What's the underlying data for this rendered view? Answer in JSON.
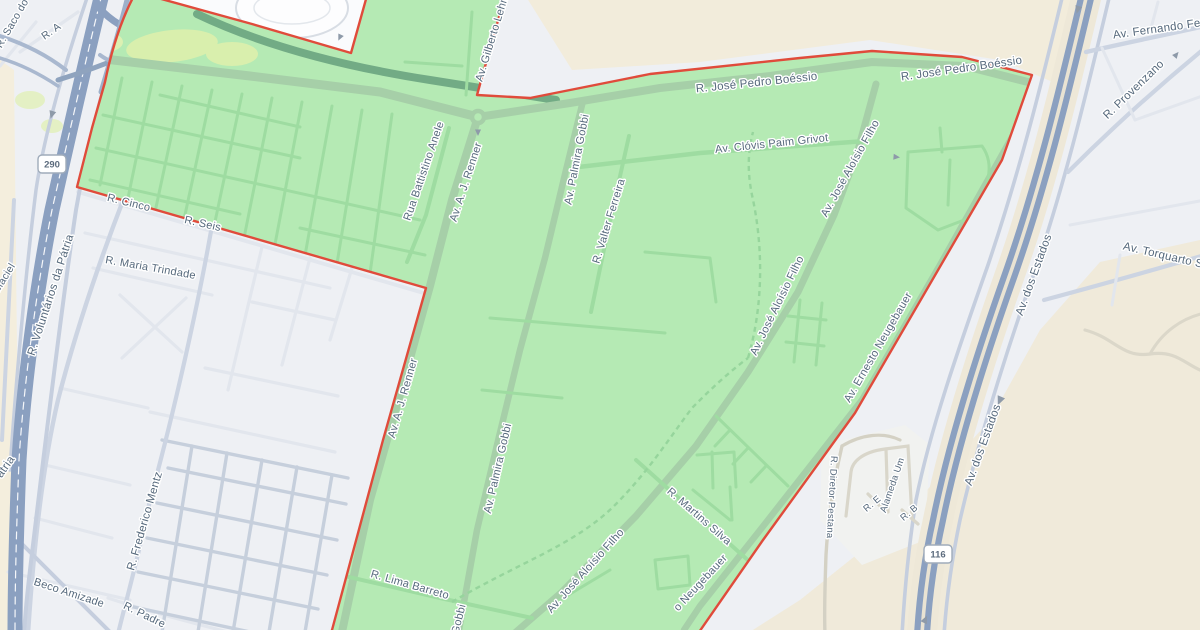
{
  "map": {
    "description": "street map with highlighted district polygon",
    "highlighted_region": {
      "name": "highlighted-district",
      "fill_color": "#b5eab4",
      "border_color": "#e04b3b"
    },
    "colors": {
      "land_base": "#eef0f4",
      "land_industrial": "#f2ecdb",
      "highway": "#8ba0c0",
      "minor_road_outside": "#e2e6ed",
      "dense_grid_road": "#c6cfdc",
      "arterial_road": "#ccd4e2",
      "green_street": "#9edca1",
      "green_major_road": "#a6cfa8",
      "dark_green_road": "#72ab85",
      "label_text": "#56697c"
    },
    "road_shields": [
      {
        "label": "290",
        "x": 52,
        "y": 164
      },
      {
        "label": "116",
        "x": 938,
        "y": 554
      }
    ],
    "street_labels": [
      {
        "text": "R. Saco do",
        "x": 15,
        "y": 25,
        "rot": -60,
        "size": 10.5
      },
      {
        "text": "R. A",
        "x": 53,
        "y": 34,
        "rot": -35,
        "size": 10.5
      },
      {
        "text": "da Maciel",
        "x": 3,
        "y": 286,
        "rot": -58,
        "size": 10.5
      },
      {
        "text": "R. Voluntários da Pátria",
        "x": 54,
        "y": 296,
        "rot": -72,
        "size": 11.5
      },
      {
        "text": "Pátria",
        "x": 6,
        "y": 472,
        "rot": -55,
        "size": 11.5
      },
      {
        "text": "R. Cinco",
        "x": 128,
        "y": 206,
        "rot": 14,
        "size": 11
      },
      {
        "text": "R. Seis",
        "x": 202,
        "y": 227,
        "rot": 13,
        "size": 11
      },
      {
        "text": "R. Maria Trindade",
        "x": 150,
        "y": 271,
        "rot": 10,
        "size": 11
      },
      {
        "text": "R. Frederico Mentz",
        "x": 148,
        "y": 522,
        "rot": -74,
        "size": 11.5
      },
      {
        "text": "Beco Amizade",
        "x": 68,
        "y": 596,
        "rot": 18,
        "size": 11
      },
      {
        "text": "R. Padre",
        "x": 143,
        "y": 618,
        "rot": 26,
        "size": 11
      },
      {
        "text": "Rua Battistino Anele",
        "x": 427,
        "y": 172,
        "rot": -71,
        "size": 11
      },
      {
        "text": "Av. A. J. Renner",
        "x": 469,
        "y": 183,
        "rot": -72,
        "size": 11
      },
      {
        "text": "Av. A. J. Renner",
        "x": 406,
        "y": 399,
        "rot": -74,
        "size": 11
      },
      {
        "text": "Av. Gilberto Lehn",
        "x": 495,
        "y": 40,
        "rot": -73,
        "size": 11
      },
      {
        "text": "Av. Palmira Gobbi",
        "x": 580,
        "y": 160,
        "rot": -79,
        "size": 11
      },
      {
        "text": "Av. Palmira Gobbi",
        "x": 501,
        "y": 469,
        "rot": -77,
        "size": 11
      },
      {
        "text": "Gobbi",
        "x": 462,
        "y": 620,
        "rot": -76,
        "size": 11
      },
      {
        "text": "R. Valter Ferreira",
        "x": 612,
        "y": 222,
        "rot": -73,
        "size": 11
      },
      {
        "text": "R. José Pedro Boéssio",
        "x": 757,
        "y": 86,
        "rot": -6,
        "size": 11.5
      },
      {
        "text": "R. José Pedro Boéssio",
        "x": 962,
        "y": 72,
        "rot": -8,
        "size": 11.5
      },
      {
        "text": "Av. Clóvis Paim Grivot",
        "x": 772,
        "y": 147,
        "rot": -6,
        "size": 11
      },
      {
        "text": "Av. José Aloísio Filho",
        "x": 853,
        "y": 170,
        "rot": -61,
        "size": 11
      },
      {
        "text": "Av. José Aloísio Filho",
        "x": 780,
        "y": 307,
        "rot": -64,
        "size": 11
      },
      {
        "text": "Av. José Aloísio Filho",
        "x": 588,
        "y": 573,
        "rot": -48,
        "size": 11
      },
      {
        "text": "R. Martins Silva",
        "x": 697,
        "y": 519,
        "rot": 41,
        "size": 11
      },
      {
        "text": "Av. Ernesto Neugebauer",
        "x": 881,
        "y": 349,
        "rot": -60,
        "size": 11
      },
      {
        "text": "o Neugebauer",
        "x": 703,
        "y": 585,
        "rot": -47,
        "size": 11
      },
      {
        "text": "Av. dos Estados",
        "x": 1037,
        "y": 276,
        "rot": -70,
        "size": 11.5
      },
      {
        "text": "Av. dos Estados",
        "x": 986,
        "y": 446,
        "rot": -70,
        "size": 11.5
      },
      {
        "text": "Av. Fernando Ferrari",
        "x": 1168,
        "y": 31,
        "rot": -8,
        "size": 11.5
      },
      {
        "text": "R. Provenzano",
        "x": 1136,
        "y": 92,
        "rot": -44,
        "size": 11.5
      },
      {
        "text": "Av. Torquarto Severo",
        "x": 1177,
        "y": 262,
        "rot": 13,
        "size": 11.5
      },
      {
        "text": "Alameda Um",
        "x": 895,
        "y": 486,
        "rot": -71,
        "size": 9.5
      },
      {
        "text": "R. Diretor Pestana",
        "x": 829,
        "y": 497,
        "rot": 93,
        "size": 9.5
      },
      {
        "text": "R. E",
        "x": 874,
        "y": 506,
        "rot": -40,
        "size": 9.5
      },
      {
        "text": "R. B",
        "x": 911,
        "y": 515,
        "rot": -40,
        "size": 9.5
      },
      {
        "text": "R. Lima Barreto",
        "x": 409,
        "y": 588,
        "rot": 16,
        "size": 11
      }
    ]
  }
}
